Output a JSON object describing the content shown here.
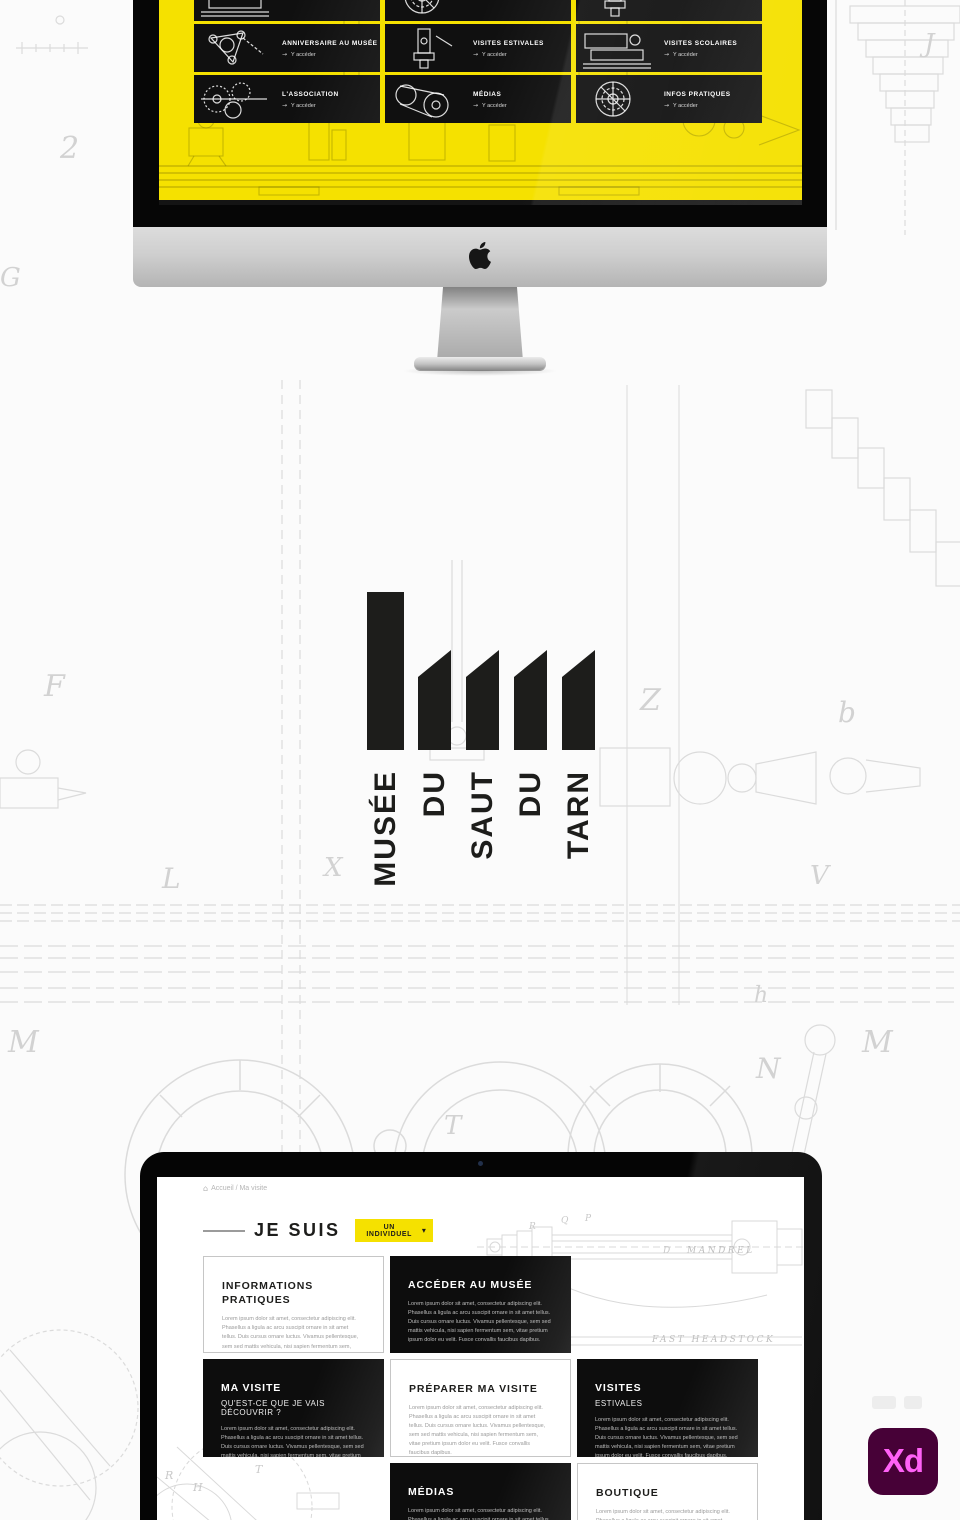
{
  "colors": {
    "accent_yellow": "#F5E100",
    "tile_black": "#121212",
    "card_black": "#111111",
    "logo_black": "#1D1D1B",
    "xd_badge_bg": "#470137",
    "xd_badge_text": "#FF61F6"
  },
  "imac": {
    "screen": {
      "link_arrow": "→",
      "tiles": [
        {
          "title": "",
          "link": "Y accéder"
        },
        {
          "title": "",
          "link": "Y accéder"
        },
        {
          "title": "",
          "link": "Y accéder"
        },
        {
          "title": "ANNIVERSAIRE AU MUSÉE",
          "link": "Y accéder"
        },
        {
          "title": "VISITES ESTIVALES",
          "link": "Y accéder"
        },
        {
          "title": "VISITES SCOLAIRES",
          "link": "Y accéder"
        },
        {
          "title": "L'ASSOCIATION",
          "link": "Y accéder"
        },
        {
          "title": "MÉDIAS",
          "link": "Y accéder"
        },
        {
          "title": "INFOS PRATIQUES",
          "link": "Y accéder"
        }
      ]
    }
  },
  "logo": {
    "words": [
      "MUSÉE",
      "DU",
      "SAUT",
      "DU",
      "TARN"
    ]
  },
  "laptop": {
    "page": {
      "breadcrumb": {
        "home_icon": "⌂",
        "text": "Accueil / Ma visite"
      },
      "heading": "JE SUIS",
      "selector": {
        "label": "UN INDIVIDUEL",
        "chevron": "▾"
      },
      "link_arrow": "→",
      "cards": [
        {
          "style": "light",
          "title": "INFORMATIONS PRATIQUES",
          "body": "Lorem ipsum dolor sit amet, consectetur adipiscing elit. Phasellus a ligula ac arcu suscipit ornare in sit amet tellus. Duis cursus ornare luctus. Vivamus pellentesque, sem sed mattis vehicula, nisi sapien fermentum sem, vitae pretium ipsum dolor eu velit. Fusce convallis faucibus dapibus."
        },
        {
          "style": "dark",
          "title": "ACCÉDER AU MUSÉE",
          "link": "Voir plus",
          "body": "Lorem ipsum dolor sit amet, consectetur adipiscing elit. Phasellus a ligula ac arcu suscipit ornare in sit amet tellus. Duis cursus ornare luctus. Vivamus pellentesque, sem sed mattis vehicula, nisi sapien fermentum sem, vitae pretium ipsum dolor eu velit. Fusce convallis faucibus dapibus."
        },
        {
          "style": "dark",
          "title": "MA VISITE",
          "subtitle": "QU'EST-CE QUE JE VAIS DÉCOUVRIR ?",
          "body": "Lorem ipsum dolor sit amet, consectetur adipiscing elit. Phasellus a ligula ac arcu suscipit ornare in sit amet tellus. Duis cursus ornare luctus. Vivamus pellentesque, sem sed mattis vehicula, nisi sapien fermentum sem, vitae pretium ipsum dolor eu velit. Fusce convallis faucibus dapibus."
        },
        {
          "style": "light",
          "title": "PRÉPARER MA VISITE",
          "body": "Lorem ipsum dolor sit amet, consectetur adipiscing elit. Phasellus a ligula ac arcu suscipit ornare in sit amet tellus. Duis cursus ornare luctus. Vivamus pellentesque, sem sed mattis vehicula, nisi sapien fermentum sem, vitae pretium ipsum dolor eu velit. Fusce convallis faucibus dapibus."
        },
        {
          "style": "dark",
          "title": "VISITES",
          "subtitle": "ESTIVALES",
          "body": "Lorem ipsum dolor sit amet, consectetur adipiscing elit. Phasellus a ligula ac arcu suscipit ornare in sit amet tellus. Duis cursus ornare luctus. Vivamus pellentesque, sem sed mattis vehicula, nisi sapien fermentum sem, vitae pretium ipsum dolor eu velit. Fusce convallis faucibus dapibus."
        },
        {
          "style": "dark",
          "title": "MÉDIAS",
          "body": "Lorem ipsum dolor sit amet, consectetur adipiscing elit. Phasellus a ligula ac arcu suscipit ornare in sit amet tellus. Duis cursus ornare luctus. Vivamus pellentesque, sem sed mattis vehicula, nisi sapien fermentum sem, vitae pretium ipsum dolor eu velit. Fusce convallis faucibus dapibus."
        },
        {
          "style": "light",
          "title": "BOUTIQUE",
          "body": "Lorem ipsum dolor sit amet, consectetur adipiscing elit. Phasellus a ligula ac arcu suscipit ornare in sit amet tellus. Duis cursus ornare luctus. Vivamus pellentesque, sem sed mattis vehicula, nisi sapien fermentum sem, vitae pretium ipsum dolor eu velit. Fusce convallis faucibus dapibus."
        }
      ],
      "drawing_labels": {
        "mandrel": "MANDREL",
        "headstock": "FAST HEADSTOCK"
      },
      "drawing_letters": [
        "R",
        "Q",
        "P",
        "D",
        "R",
        "H",
        "T"
      ]
    }
  },
  "xd_badge": "Xd",
  "background_letters": [
    "2",
    "G",
    "J",
    "F",
    "L",
    "X",
    "Z",
    "b",
    "V",
    "M",
    "M",
    "N",
    "T",
    "h"
  ]
}
